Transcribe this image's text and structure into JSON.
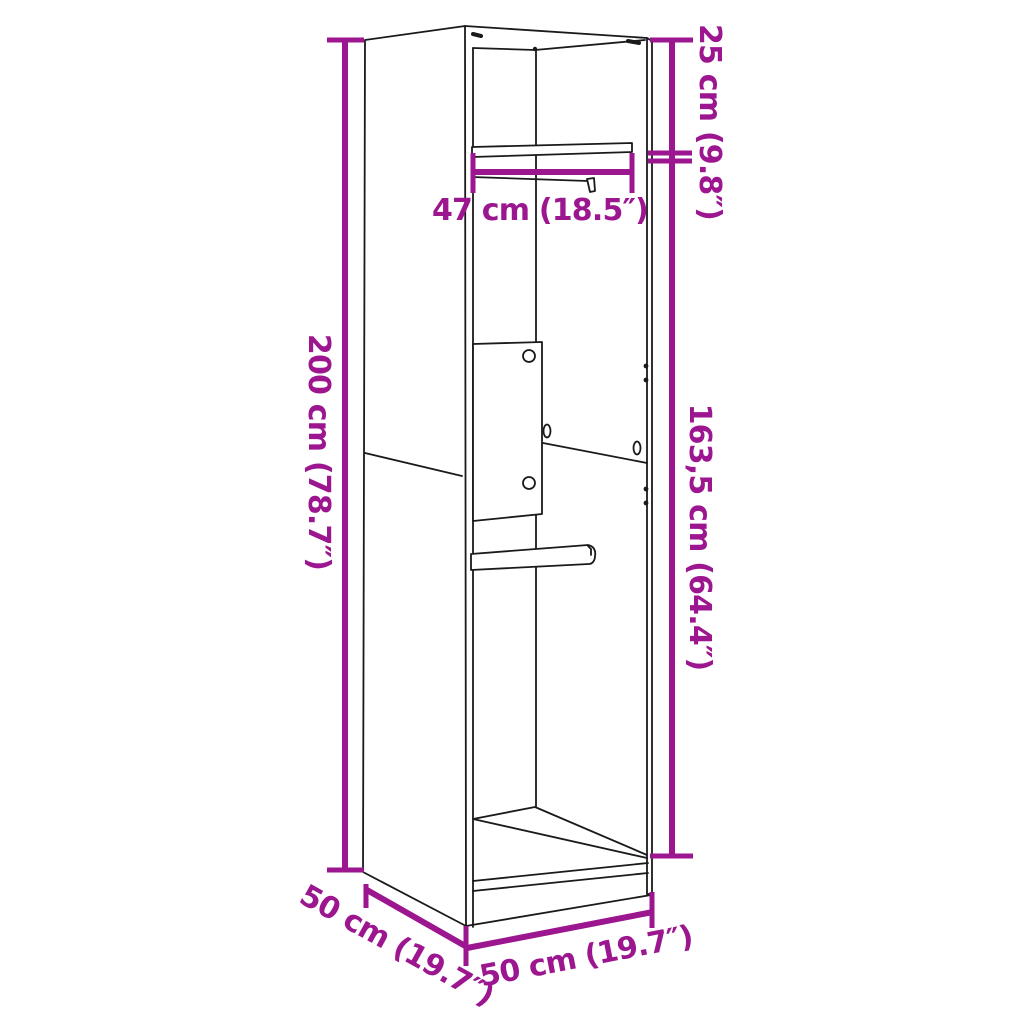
{
  "diagram": {
    "type": "furniture-dimension-diagram",
    "subject": "wardrobe",
    "background_color": "#ffffff",
    "line_color": "#1a1a1a",
    "accent_color": "#9C1690",
    "labels": {
      "height": "200 cm (78.7″)",
      "top_offset": "25 cm (9.8″)",
      "rail_height": "163,5 cm (64.4″)",
      "inner_width": "47 cm (18.5″)",
      "depth": "50 cm (19.7″)",
      "width": "50 cm (19.7″)"
    },
    "values": {
      "height_cm": "200",
      "top_offset_cm": "25",
      "rail_height_cm": "163,5",
      "inner_width_cm": "47",
      "depth_cm": "50",
      "width_cm": "50"
    }
  }
}
